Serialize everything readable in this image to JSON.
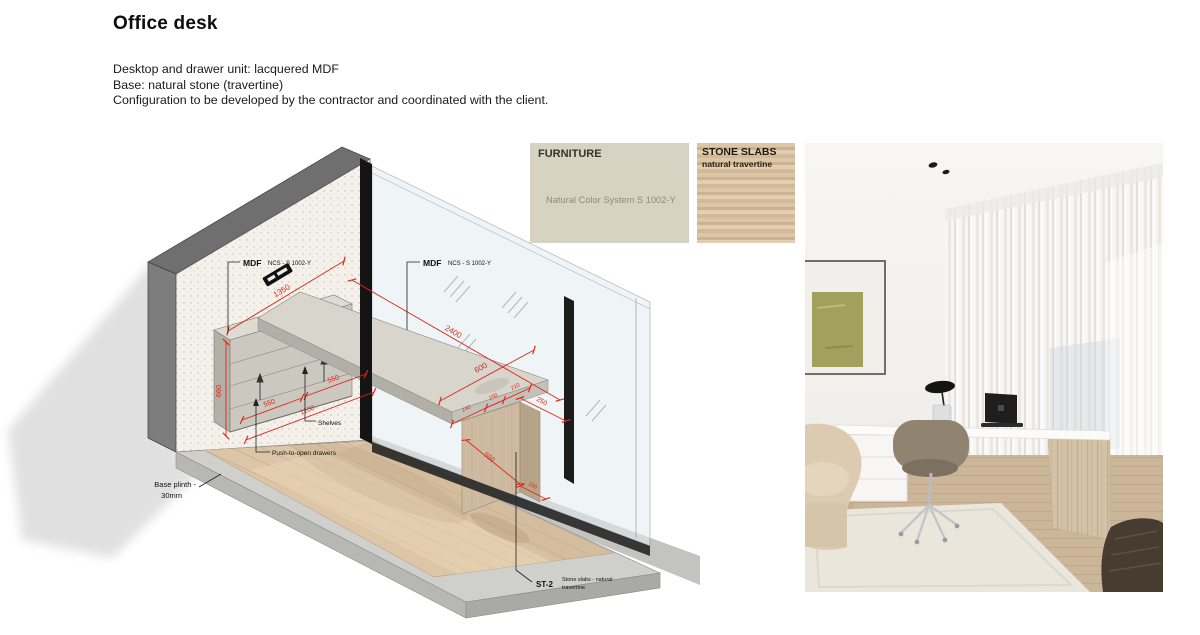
{
  "page": {
    "title": "Office desk",
    "description": [
      "Desktop and drawer unit: lacquered MDF",
      "Base: natural stone (travertine)",
      "Configuration to be developed by the contractor and coordinated with the client."
    ]
  },
  "swatches": {
    "furniture": {
      "heading": "FURNITURE",
      "note": "Natural Color System S 1002-Y",
      "color": "#d7d3c2"
    },
    "stone": {
      "heading": "STONE SLABS",
      "subheading": "natural travertine",
      "color": "#d8c1a3"
    }
  },
  "drawing": {
    "labels": {
      "mdf": "MDF",
      "mdf_spec": "NCS - S 1002-Y",
      "shelves": "Shelves",
      "push_drawers": "Push-to-open drawers",
      "base_plinth_line1": "Base plinth -",
      "base_plinth_line2": "30mm",
      "stone_tag": "ST-2",
      "stone_desc_line1": "Stone slabs - natural",
      "stone_desc_line2": "travertine"
    },
    "dimensions": {
      "wall_length": "1350",
      "desk_length": "2400",
      "desk_depth": "600",
      "desk_overhang": "250",
      "unit_height": "660",
      "drawer_left": "550",
      "drawer_right": "550",
      "unit_length": "1100",
      "seg_left": "240",
      "base_top": "150",
      "seg_right": "210",
      "base_height": "550",
      "base_width": "150"
    },
    "colors": {
      "dimension_red": "#e02619",
      "mdf_grey": "#cbc8c0",
      "travertine": "#cdbaa0"
    }
  }
}
